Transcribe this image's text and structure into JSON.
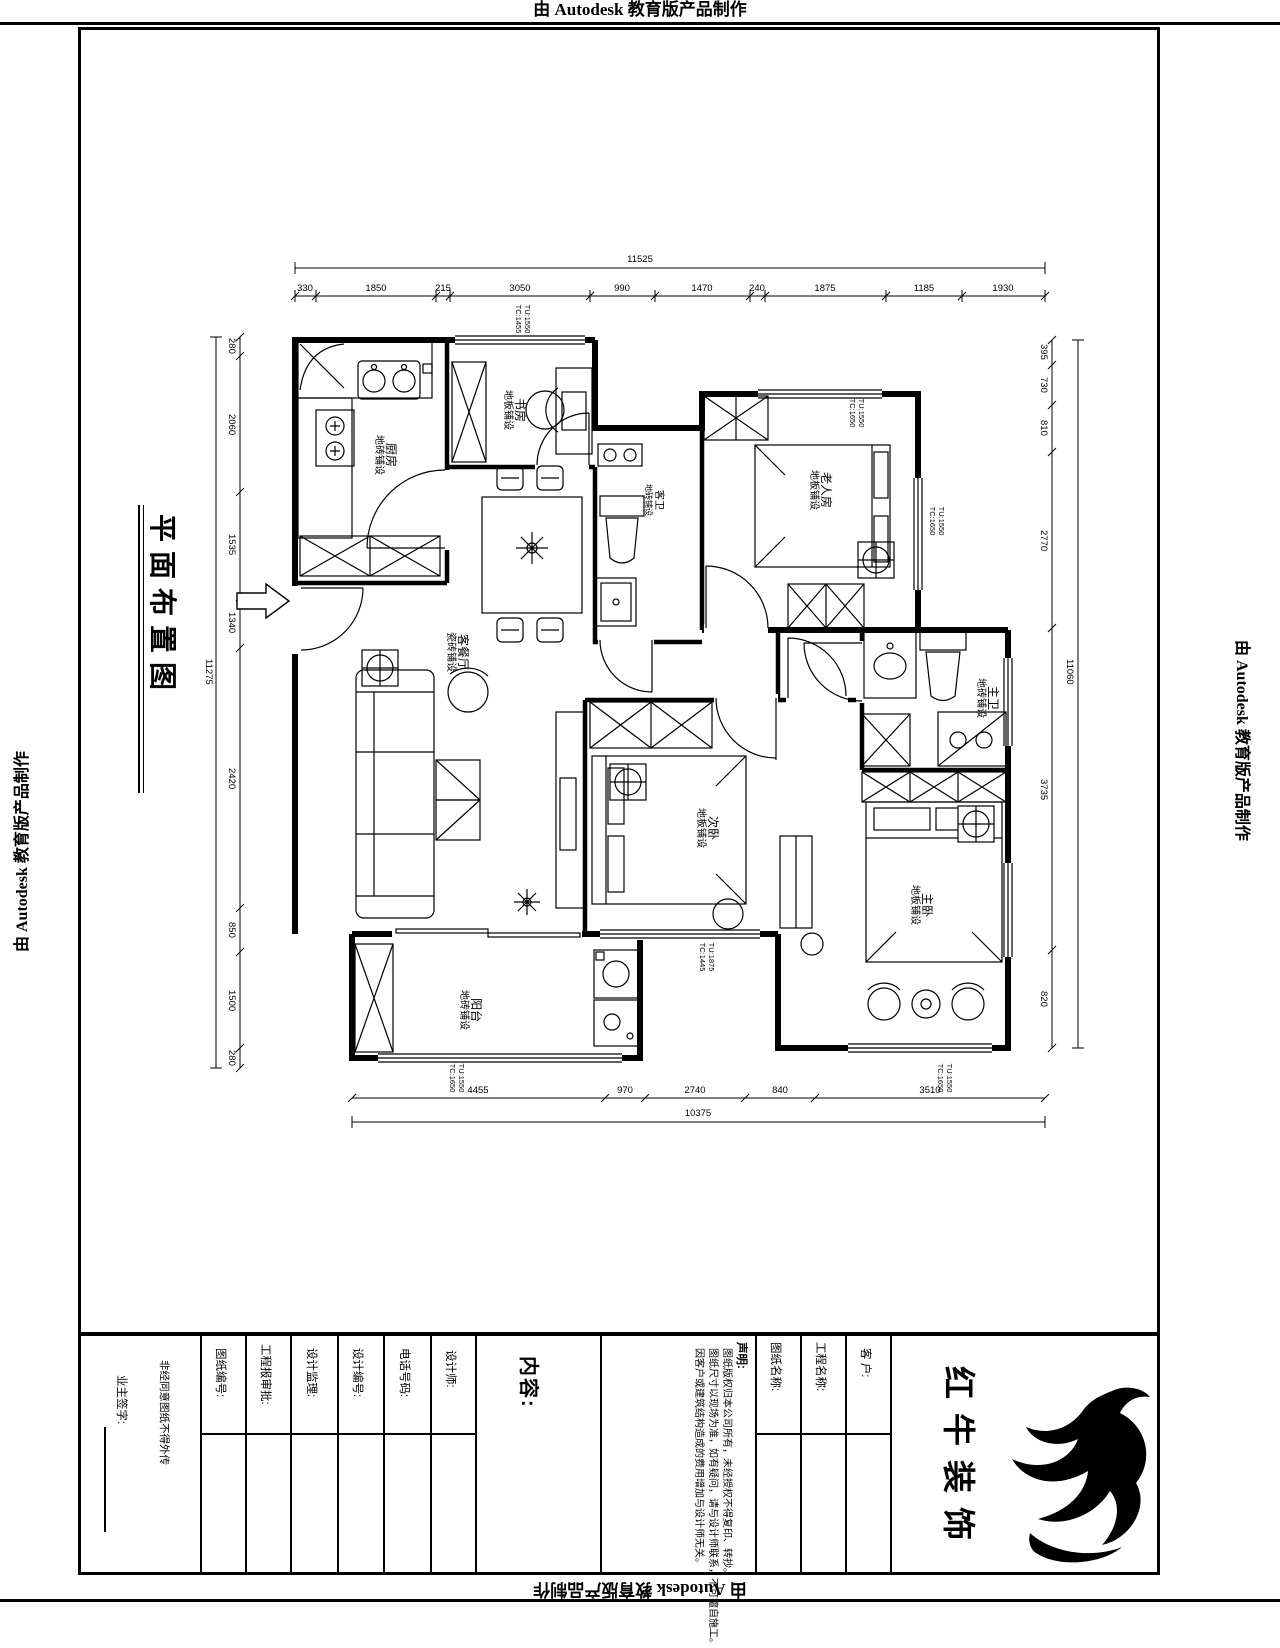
{
  "banner_text": "由 Autodesk 教育版产品制作",
  "sheet_title": "平面布置图",
  "rooms": [
    {
      "name": "厨房",
      "floor": "地砖铺设"
    },
    {
      "name": "书房",
      "floor": "地板铺设"
    },
    {
      "name": "客卫",
      "floor": "地砖铺设"
    },
    {
      "name": "老人房",
      "floor": "地板铺设"
    },
    {
      "name": "客餐厅",
      "floor": "瓷砖铺设"
    },
    {
      "name": "次卧",
      "floor": "地板铺设"
    },
    {
      "name": "主卫",
      "floor": "地砖铺设"
    },
    {
      "name": "主卧",
      "floor": "地板铺设"
    },
    {
      "name": "阳台",
      "floor": "地砖铺设"
    }
  ],
  "dims": {
    "top_total": "11525",
    "top": [
      "330",
      "1850",
      "215",
      "3050",
      "990",
      "1470",
      "240",
      "1875",
      "1185",
      "1930"
    ],
    "left_total": "11275",
    "left": [
      "280",
      "2060",
      "1535",
      "1340",
      "2420",
      "850",
      "1500",
      "280"
    ],
    "right_total": "11060",
    "right": [
      "395",
      "730",
      "810",
      "2770",
      "3735",
      "820"
    ],
    "bottom_total": "10375",
    "bottom": [
      "4455",
      "970",
      "2740",
      "840",
      "3510"
    ]
  },
  "window_tags": [
    {
      "l1": "TU:1550",
      "l2": "TC:1455"
    },
    {
      "l1": "TU:1550",
      "l2": "TC:1650"
    },
    {
      "l1": "TU:1550",
      "l2": "TC:1650"
    },
    {
      "l1": "TU:1875",
      "l2": "TC:1445"
    },
    {
      "l1": "TU:1550",
      "l2": "TC:1650"
    },
    {
      "l1": "TU:1550",
      "l2": "TC:1650"
    }
  ],
  "title_block": {
    "owner_sign_label": "业主签字:",
    "note_column": "非经同意图纸不得外传",
    "fields": [
      "图纸编号:",
      "工程报审批:",
      "设计监理:",
      "设计编号:",
      "电话号码:",
      "设计师:"
    ],
    "content_label": "内容:",
    "statement_label": "声明:",
    "statements": [
      "图纸版权归本公司所有，未经授权不得复印、转抄。",
      "图纸尺寸以现场为准，如有疑问，请与设计师联系，不可擅自施工。",
      "因客户或建筑结构造成的费用增加与设计师无关。"
    ],
    "drawing_name_label": "图纸名称:",
    "project_name_label": "工程名称:",
    "client_label": "客 户:",
    "company": "红牛装饰"
  }
}
